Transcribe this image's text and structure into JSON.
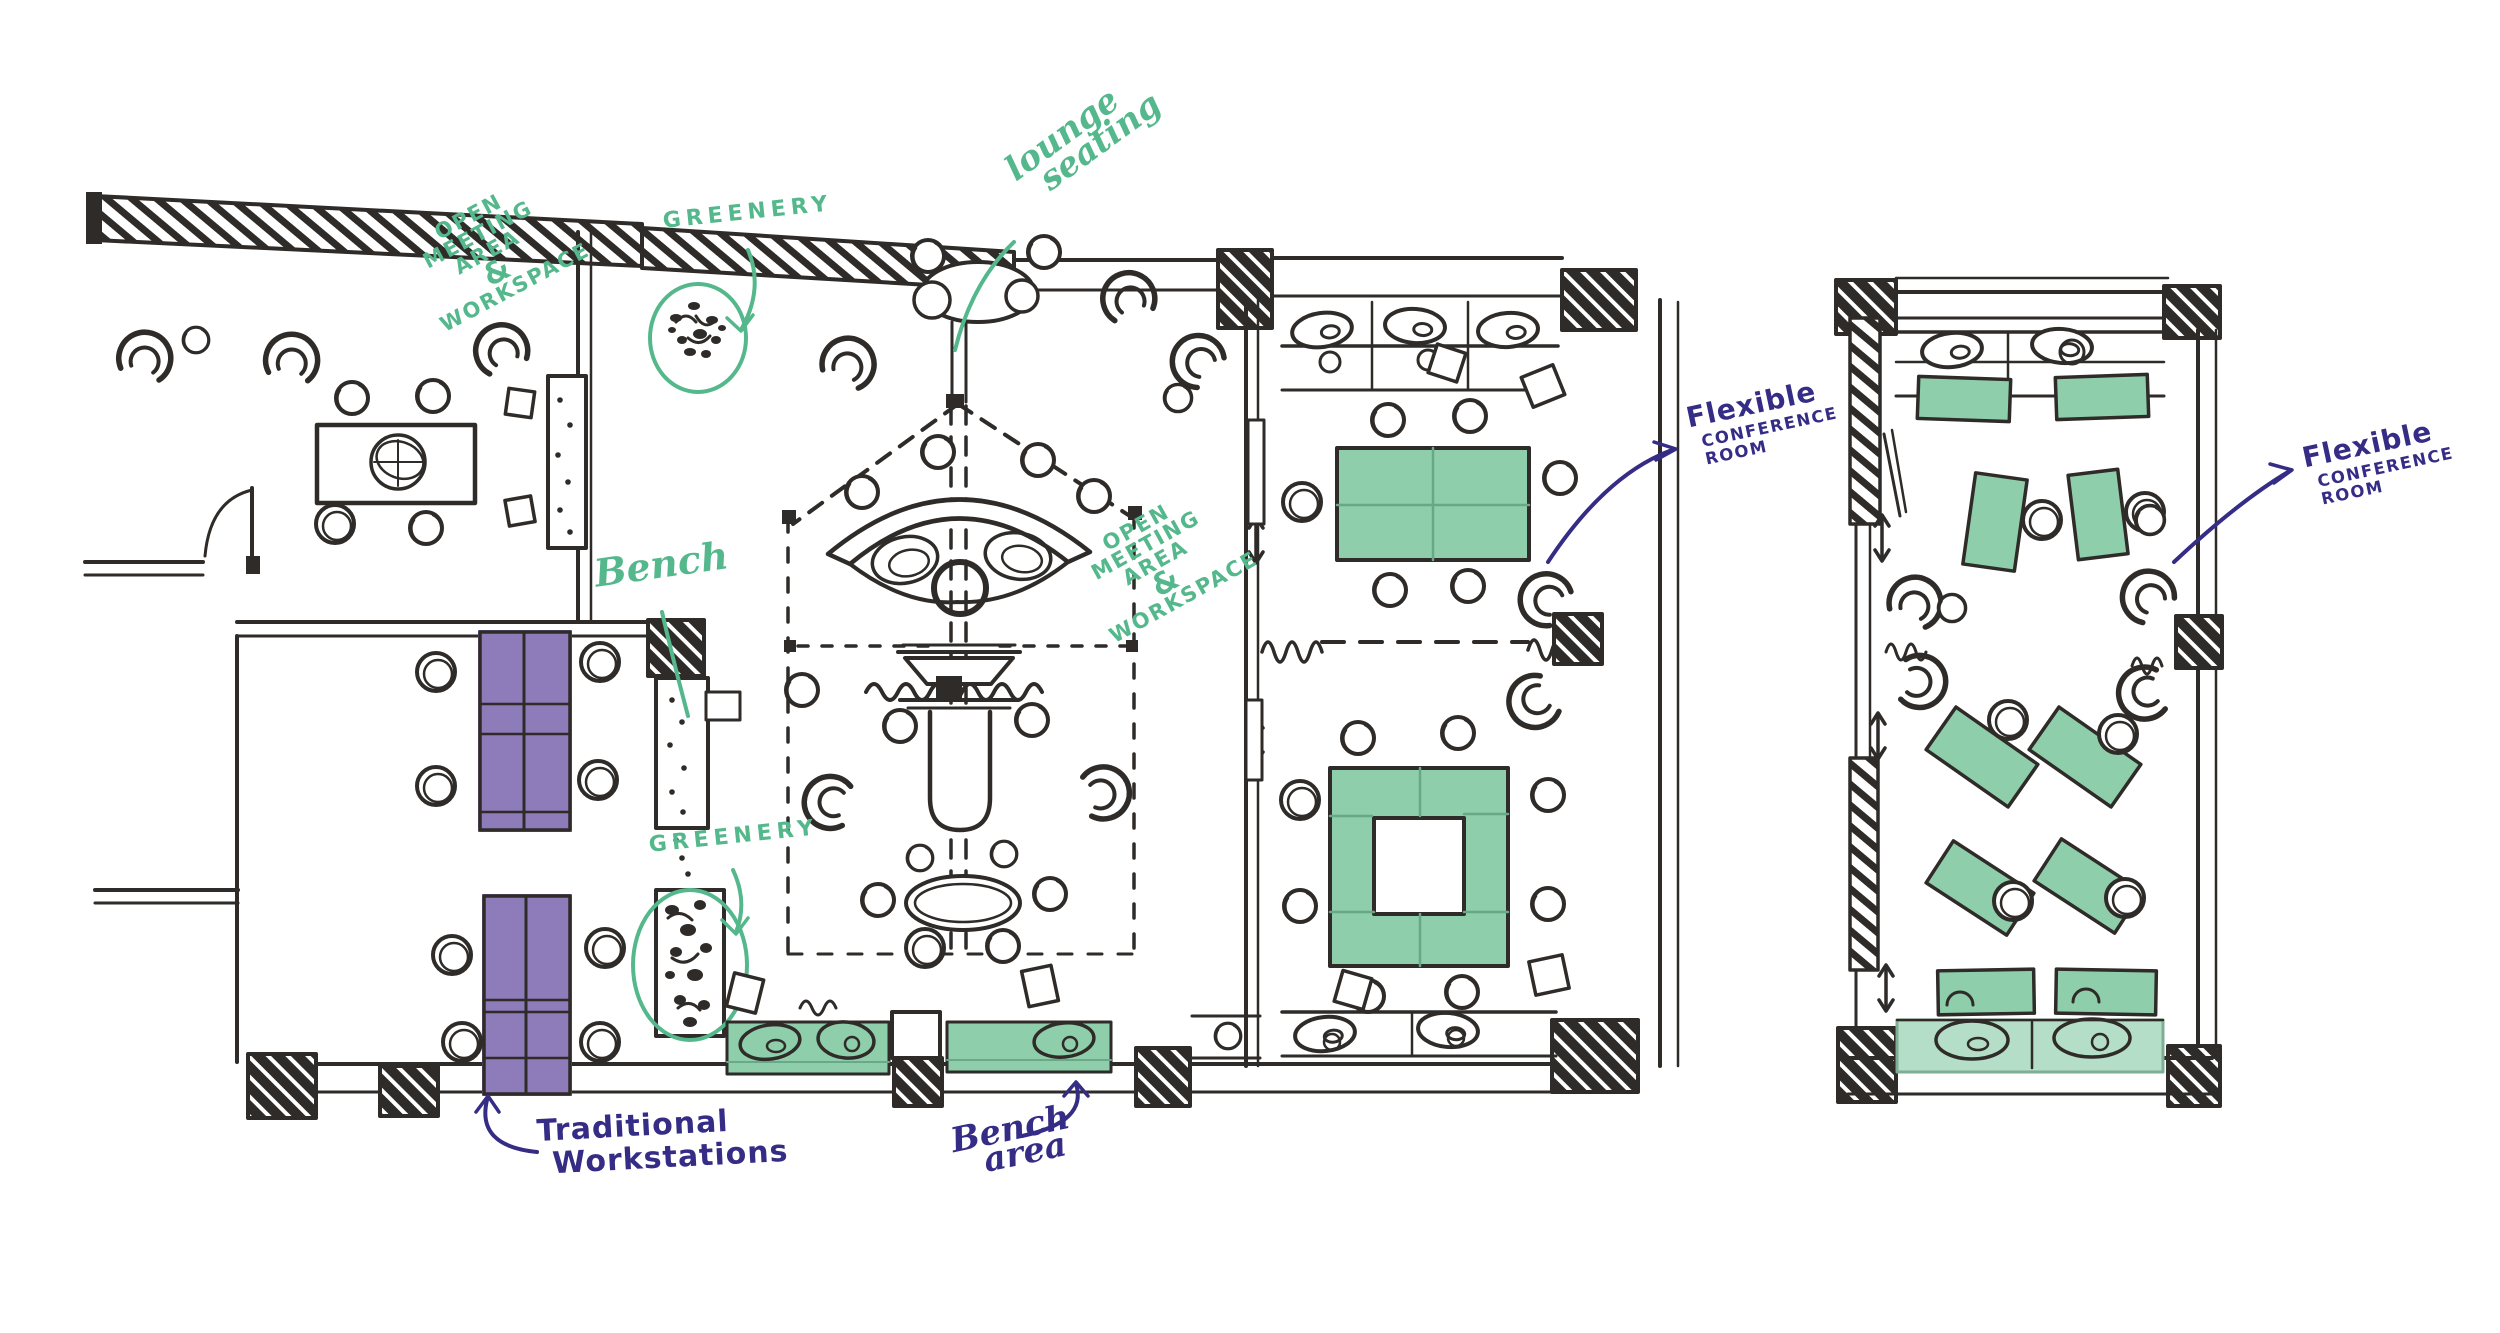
{
  "title": "Hand-drawn office floor plan concept sketch",
  "colors": {
    "background": "#ffffff",
    "sketch_ink": "#2e2b28",
    "annotation_green": "#55b88c",
    "annotation_blue": "#352c86",
    "furniture_green": "#8fceab",
    "furniture_green_light": "#b4dec7",
    "furniture_purple": "#8d7bba"
  },
  "main_plan": {
    "name": "Main office floor plan",
    "labels": {
      "open_meeting_top": {
        "lines": [
          "OPEN",
          "MEETING",
          "AREA",
          "&",
          "WORKSPACE"
        ]
      },
      "greenery_top": {
        "text": "GREENERY"
      },
      "lounge_seating": {
        "lines": [
          "lounge",
          "seating"
        ]
      },
      "bench": {
        "text": "Bench"
      },
      "open_meeting_center": {
        "lines": [
          "OPEN",
          "MEETING",
          "AREA",
          "&",
          "WORKSPACE"
        ]
      },
      "greenery_mid": {
        "text": "GREENERY"
      },
      "flexible_conference": {
        "lines": [
          "Flexible",
          "CONFERENCE",
          "ROOM"
        ]
      },
      "traditional_workstations": {
        "lines": [
          "Traditional",
          "Workstations"
        ]
      },
      "bench_area": {
        "lines": [
          "Bench",
          "area"
        ]
      }
    }
  },
  "secondary_plan": {
    "name": "Flexible conference room plan",
    "labels": {
      "flexible_conference": {
        "lines": [
          "Flexible",
          "CONFERENCE",
          "ROOM"
        ]
      }
    }
  }
}
